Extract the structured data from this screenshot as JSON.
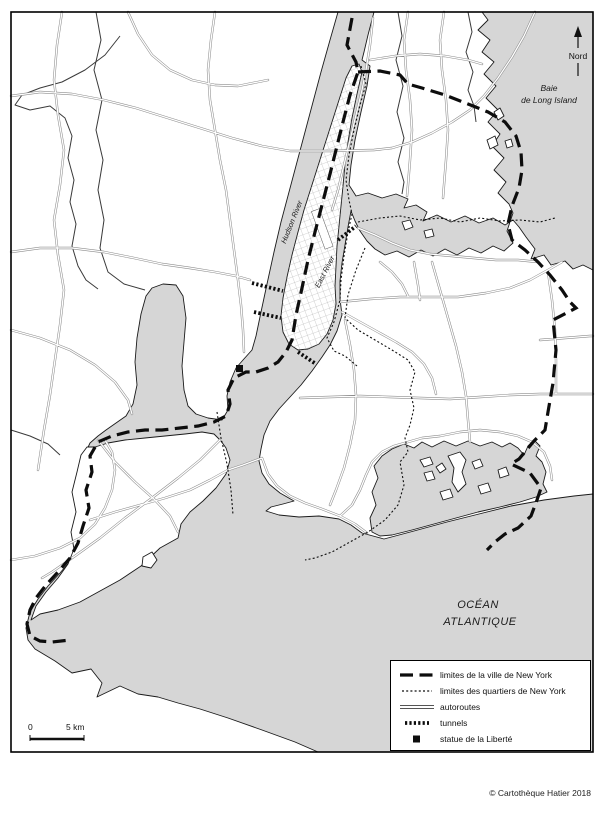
{
  "map": {
    "north_label": "Nord",
    "bay_label_1": "Baie",
    "bay_label_2": "de Long Island",
    "hudson_label": "Hudson River",
    "east_river_label": "East River",
    "ocean_label_1": "OCÉAN",
    "ocean_label_2": "ATLANTIQUE"
  },
  "scale": {
    "zero": "0",
    "distance": "5 km"
  },
  "legend": {
    "items": [
      {
        "symbol": "city-limit-dash",
        "label": "limites de la ville de New York"
      },
      {
        "symbol": "quarter-limit-dots",
        "label": "limites des quartiers de New York"
      },
      {
        "symbol": "double-line",
        "label": "autoroutes"
      },
      {
        "symbol": "tunnel-ticks",
        "label": "tunnels"
      },
      {
        "symbol": "black-square",
        "label": "statue de la Liberté"
      }
    ]
  },
  "footer": {
    "copyright": "© Cartothèque Hatier 2018"
  },
  "colors": {
    "water": "#d6d6d6",
    "coastline": "#1a1a1a",
    "road_casing": "#8c8c8c",
    "boundary": "#0d0d0d"
  }
}
